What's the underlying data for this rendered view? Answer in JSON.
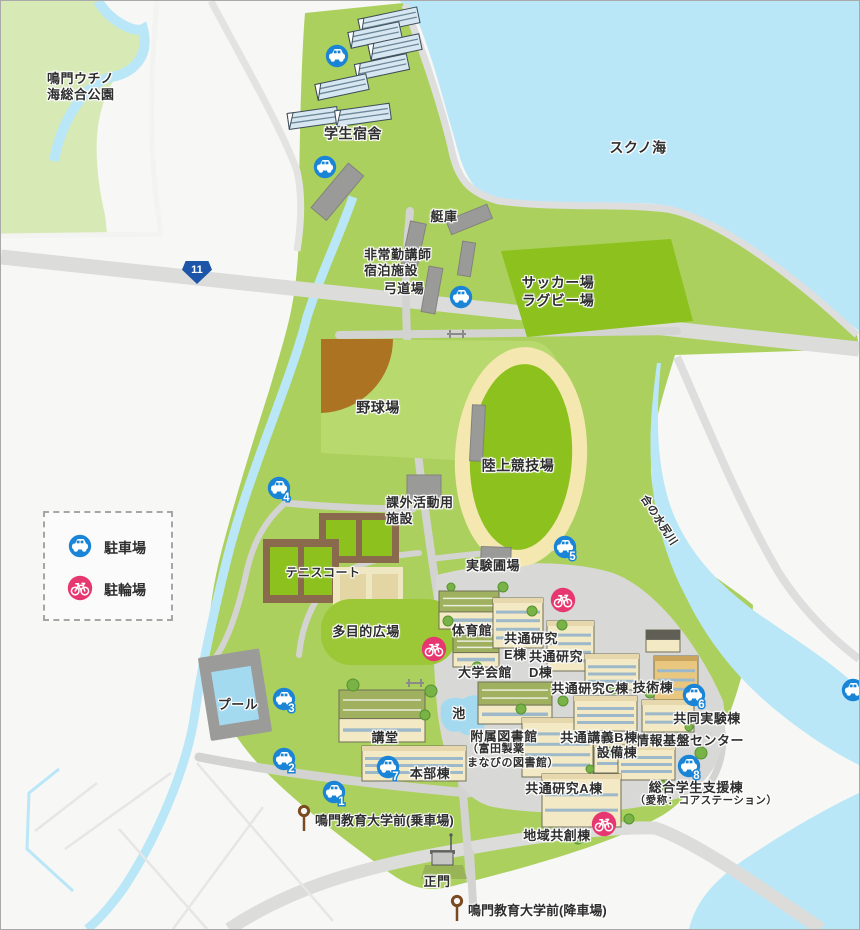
{
  "map": {
    "legend": {
      "parking": "駐車場",
      "bicycle": "駐輪場"
    },
    "route_badge": "11",
    "labels": [
      {
        "id": "park-name",
        "text": "鳴門ウチノ\n海総合公園",
        "x": 46,
        "y": 70,
        "size": 13,
        "align": "left"
      },
      {
        "id": "student-dorm",
        "text": "学生宿舎",
        "x": 352,
        "y": 133,
        "size": 14
      },
      {
        "id": "sea-name",
        "text": "スクノ海",
        "x": 637,
        "y": 147,
        "size": 14
      },
      {
        "id": "boathouse",
        "text": "艇庫",
        "x": 443,
        "y": 216,
        "size": 13
      },
      {
        "id": "lecturer-lodging",
        "text": "非常勤講師\n宿泊施設",
        "x": 363,
        "y": 246,
        "size": 13,
        "align": "left"
      },
      {
        "id": "archery-range",
        "text": "弓道場",
        "x": 403,
        "y": 288,
        "size": 13
      },
      {
        "id": "soccer-rugby",
        "text": "サッカー場\nラグビー場",
        "x": 557,
        "y": 291,
        "size": 14
      },
      {
        "id": "baseball-field",
        "text": "野球場",
        "x": 377,
        "y": 407,
        "size": 14
      },
      {
        "id": "athletics-track",
        "text": "陸上競技場",
        "x": 517,
        "y": 465,
        "size": 14
      },
      {
        "id": "extracurricular",
        "text": "課外活動用\n施設",
        "x": 385,
        "y": 494,
        "size": 13,
        "align": "left"
      },
      {
        "id": "experiment-field",
        "text": "実験圃場",
        "x": 492,
        "y": 565,
        "size": 13
      },
      {
        "id": "tennis-courts",
        "text": "テニスコート",
        "x": 322,
        "y": 572,
        "size": 12
      },
      {
        "id": "multipurpose-plaza",
        "text": "多目的広場",
        "x": 365,
        "y": 631,
        "size": 13
      },
      {
        "id": "gymnasium",
        "text": "体育館",
        "x": 471,
        "y": 630,
        "size": 13
      },
      {
        "id": "research-e",
        "text": "共通研究\nE棟",
        "x": 503,
        "y": 630,
        "size": 13,
        "align": "left"
      },
      {
        "id": "research-d",
        "text": "共通研究\nD棟",
        "x": 528,
        "y": 648,
        "size": 13,
        "align": "left"
      },
      {
        "id": "university-hall",
        "text": "大学会館",
        "x": 484,
        "y": 672,
        "size": 13
      },
      {
        "id": "research-c",
        "text": "共通研究C棟",
        "x": 589,
        "y": 688,
        "size": 13
      },
      {
        "id": "technical-bldg",
        "text": "技術棟",
        "x": 652,
        "y": 687,
        "size": 13
      },
      {
        "id": "joint-lab",
        "text": "共同実験棟",
        "x": 706,
        "y": 718,
        "size": 13
      },
      {
        "id": "info-center",
        "text": "情報基盤センター",
        "x": 689,
        "y": 740,
        "size": 13
      },
      {
        "id": "lecture-b",
        "text": "共通講義B棟",
        "x": 598,
        "y": 737,
        "size": 13
      },
      {
        "id": "facilities-bldg",
        "text": "設備棟",
        "x": 616,
        "y": 752,
        "size": 13
      },
      {
        "id": "pool",
        "text": "プール",
        "x": 237,
        "y": 704,
        "size": 13
      },
      {
        "id": "pond",
        "text": "池",
        "x": 458,
        "y": 713,
        "size": 13
      },
      {
        "id": "auditorium",
        "text": "講堂",
        "x": 384,
        "y": 737,
        "size": 13
      },
      {
        "id": "library",
        "text": "附属図書館",
        "x": 503,
        "y": 736,
        "size": 13
      },
      {
        "id": "library-sub",
        "text": "（富田製薬\nまなびの図書館）",
        "x": 466,
        "y": 742,
        "size": 11,
        "align": "left"
      },
      {
        "id": "hq-bldg",
        "text": "本部棟",
        "x": 429,
        "y": 773,
        "size": 13
      },
      {
        "id": "research-a",
        "text": "共通研究A棟",
        "x": 563,
        "y": 788,
        "size": 13
      },
      {
        "id": "student-support",
        "text": "総合学生支援棟",
        "x": 695,
        "y": 787,
        "size": 13
      },
      {
        "id": "student-support-alias",
        "text": "（愛称：コアステーション）",
        "x": 705,
        "y": 800,
        "size": 10.5
      },
      {
        "id": "community-bldg",
        "text": "地域共創棟",
        "x": 556,
        "y": 835,
        "size": 13
      },
      {
        "id": "main-gate",
        "text": "正門",
        "x": 436,
        "y": 881,
        "size": 13
      },
      {
        "id": "river-name",
        "text": "合の水尻川",
        "x": 657,
        "y": 520,
        "size": 11,
        "rot": 57
      }
    ],
    "parking_icons": [
      {
        "x": 336,
        "y": 55
      },
      {
        "x": 324,
        "y": 166
      },
      {
        "x": 460,
        "y": 296
      },
      {
        "x": 278,
        "y": 487,
        "num": "4"
      },
      {
        "x": 564,
        "y": 546,
        "num": "5"
      },
      {
        "x": 283,
        "y": 698,
        "num": "3"
      },
      {
        "x": 283,
        "y": 758,
        "num": "2"
      },
      {
        "x": 333,
        "y": 791,
        "num": "1"
      },
      {
        "x": 387,
        "y": 766,
        "num": "7"
      },
      {
        "x": 693,
        "y": 694,
        "num": "6"
      },
      {
        "x": 688,
        "y": 765,
        "num": "8"
      },
      {
        "x": 852,
        "y": 689
      }
    ],
    "bicycle_icons": [
      {
        "x": 562,
        "y": 599
      },
      {
        "x": 433,
        "y": 648
      },
      {
        "x": 603,
        "y": 823
      }
    ],
    "bus_stops": [
      {
        "x": 296,
        "y": 804,
        "label": "鳴門教育大学前(乗車場)"
      },
      {
        "x": 449,
        "y": 894,
        "label": "鳴門教育大学前(降車場)"
      }
    ],
    "colors": {
      "sea": "#b9e7f8",
      "land": "#f7f7f5",
      "park": "#d7eab6",
      "campus": "#abd05e",
      "field_dark": "#8cc11e",
      "field_light": "#b8d96d",
      "track_ring": "#f5e7b0",
      "infield_brown": "#ab7322",
      "road": "#dcdcda",
      "path": "#d3d3d1",
      "parking_blue": "#1a85d6",
      "bicycle_pink": "#e73771",
      "bus_brown": "#7a4a20",
      "building_cream": "#f3e9c4",
      "building_gray": "#9a9a98",
      "pool_blue": "#a4daf0"
    }
  }
}
